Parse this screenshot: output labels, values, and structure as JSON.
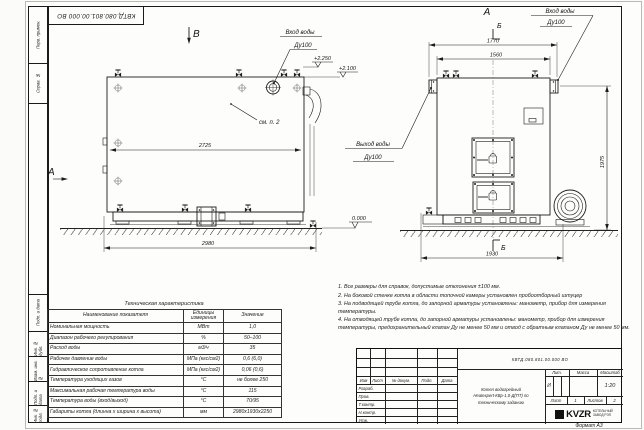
{
  "doc": {
    "number": "КВТД.080.801.00.000 ВО",
    "format_label": "Формат А3"
  },
  "margin": {
    "items": [
      "Перв. примен.",
      "Справ. №",
      "Подп. и дата",
      "Инв. № дубл.",
      "Взам. инв. №",
      "Подп. и дата",
      "Инв. № подл."
    ]
  },
  "drawing": {
    "view_b": "В",
    "view_a": "А",
    "front_view": "А",
    "section": "Б",
    "see_note": "см. п. 2",
    "inlet_line1": "Вход воды",
    "inlet_line2": "Ду100",
    "outlet_line1": "Выход воды",
    "outlet_line2": "Ду100",
    "level_top": "+2.250",
    "level_mid": "+2.100",
    "level_zero": "0.000",
    "dims": {
      "side_width": "2725",
      "side_base": "2980",
      "front_over": "1770",
      "front_width": "1560",
      "front_base": "1930",
      "front_height": "1975"
    }
  },
  "tech_table": {
    "title": "Техническая характеристика",
    "headers": [
      "Наименование показателя",
      "Единицы измерения",
      "Значение"
    ],
    "rows": [
      {
        "name": "Номинальная мощность",
        "unit": "МВт",
        "value": "1,0"
      },
      {
        "name": "Диапазон рабочего регулирования",
        "unit": "%",
        "value": "50–100"
      },
      {
        "name": "Расход воды",
        "unit": "м3/ч",
        "value": "35"
      },
      {
        "name": "Рабочее давление воды",
        "unit": "МПа (кгс/см2)",
        "value": "0,6 (6,0)"
      },
      {
        "name": "Гидравлическое сопротивление котла",
        "unit": "МПа (кгс/см2)",
        "value": "0,06 (0,6)"
      },
      {
        "name": "Температура уходящих газов",
        "unit": "°С",
        "value": "не более 250"
      },
      {
        "name": "Максимальная рабочая температура воды",
        "unit": "°С",
        "value": "115"
      },
      {
        "name": "Температура воды (вход/выход)",
        "unit": "°С",
        "value": "70/95"
      },
      {
        "name": "Габариты котла (длинна х ширина х высота)",
        "unit": "мм",
        "value": "2980х1930х2250"
      }
    ]
  },
  "notes": [
    "1. Все размеры для справок, допустимые отклонения ±100 мм.",
    "2. На боковой стенке котла в области топочной камеры установлен пробоотборный штуцер",
    "3. На подводящей трубе котла, до запорной арматуры установлены: манометр, прибор для измерения температуры.",
    "4. На отводящей трубе котла, до запорной арматуры установлены: манометр, прибор для измерения температуры, предохранительный клапан Ду не менее 50 мм и отвод с обратным клапаном Ду не менее 50 мм."
  ],
  "title_block": {
    "doc_number": "КВТД.080.801.00.000 ВО",
    "rev_headers": [
      "Изм",
      "Лист",
      "№ докум.",
      "Подп.",
      "Дата"
    ],
    "roles": [
      "Разраб.",
      "Пров.",
      "Т.контр.",
      "Н.контр.",
      "Утв."
    ],
    "name_line1": "Котел водогрейный",
    "name_line2": "Heatexpert-КВр-1,0-Д(ПТ) по",
    "name_line3": "техническому заданию",
    "lit_header": "Лит.",
    "mass_header": "Масса",
    "scale_header": "Масштаб",
    "lit_value": "И",
    "scale_value": "1:20",
    "sheet_label": "Лист",
    "sheet_value": "1",
    "sheets_label": "Листов",
    "sheets_value": "2",
    "logo_text": "KVZR",
    "logo_caption1": "КОТЕЛЬНЫЙ",
    "logo_caption2": "ЗАВОД РЭП"
  }
}
